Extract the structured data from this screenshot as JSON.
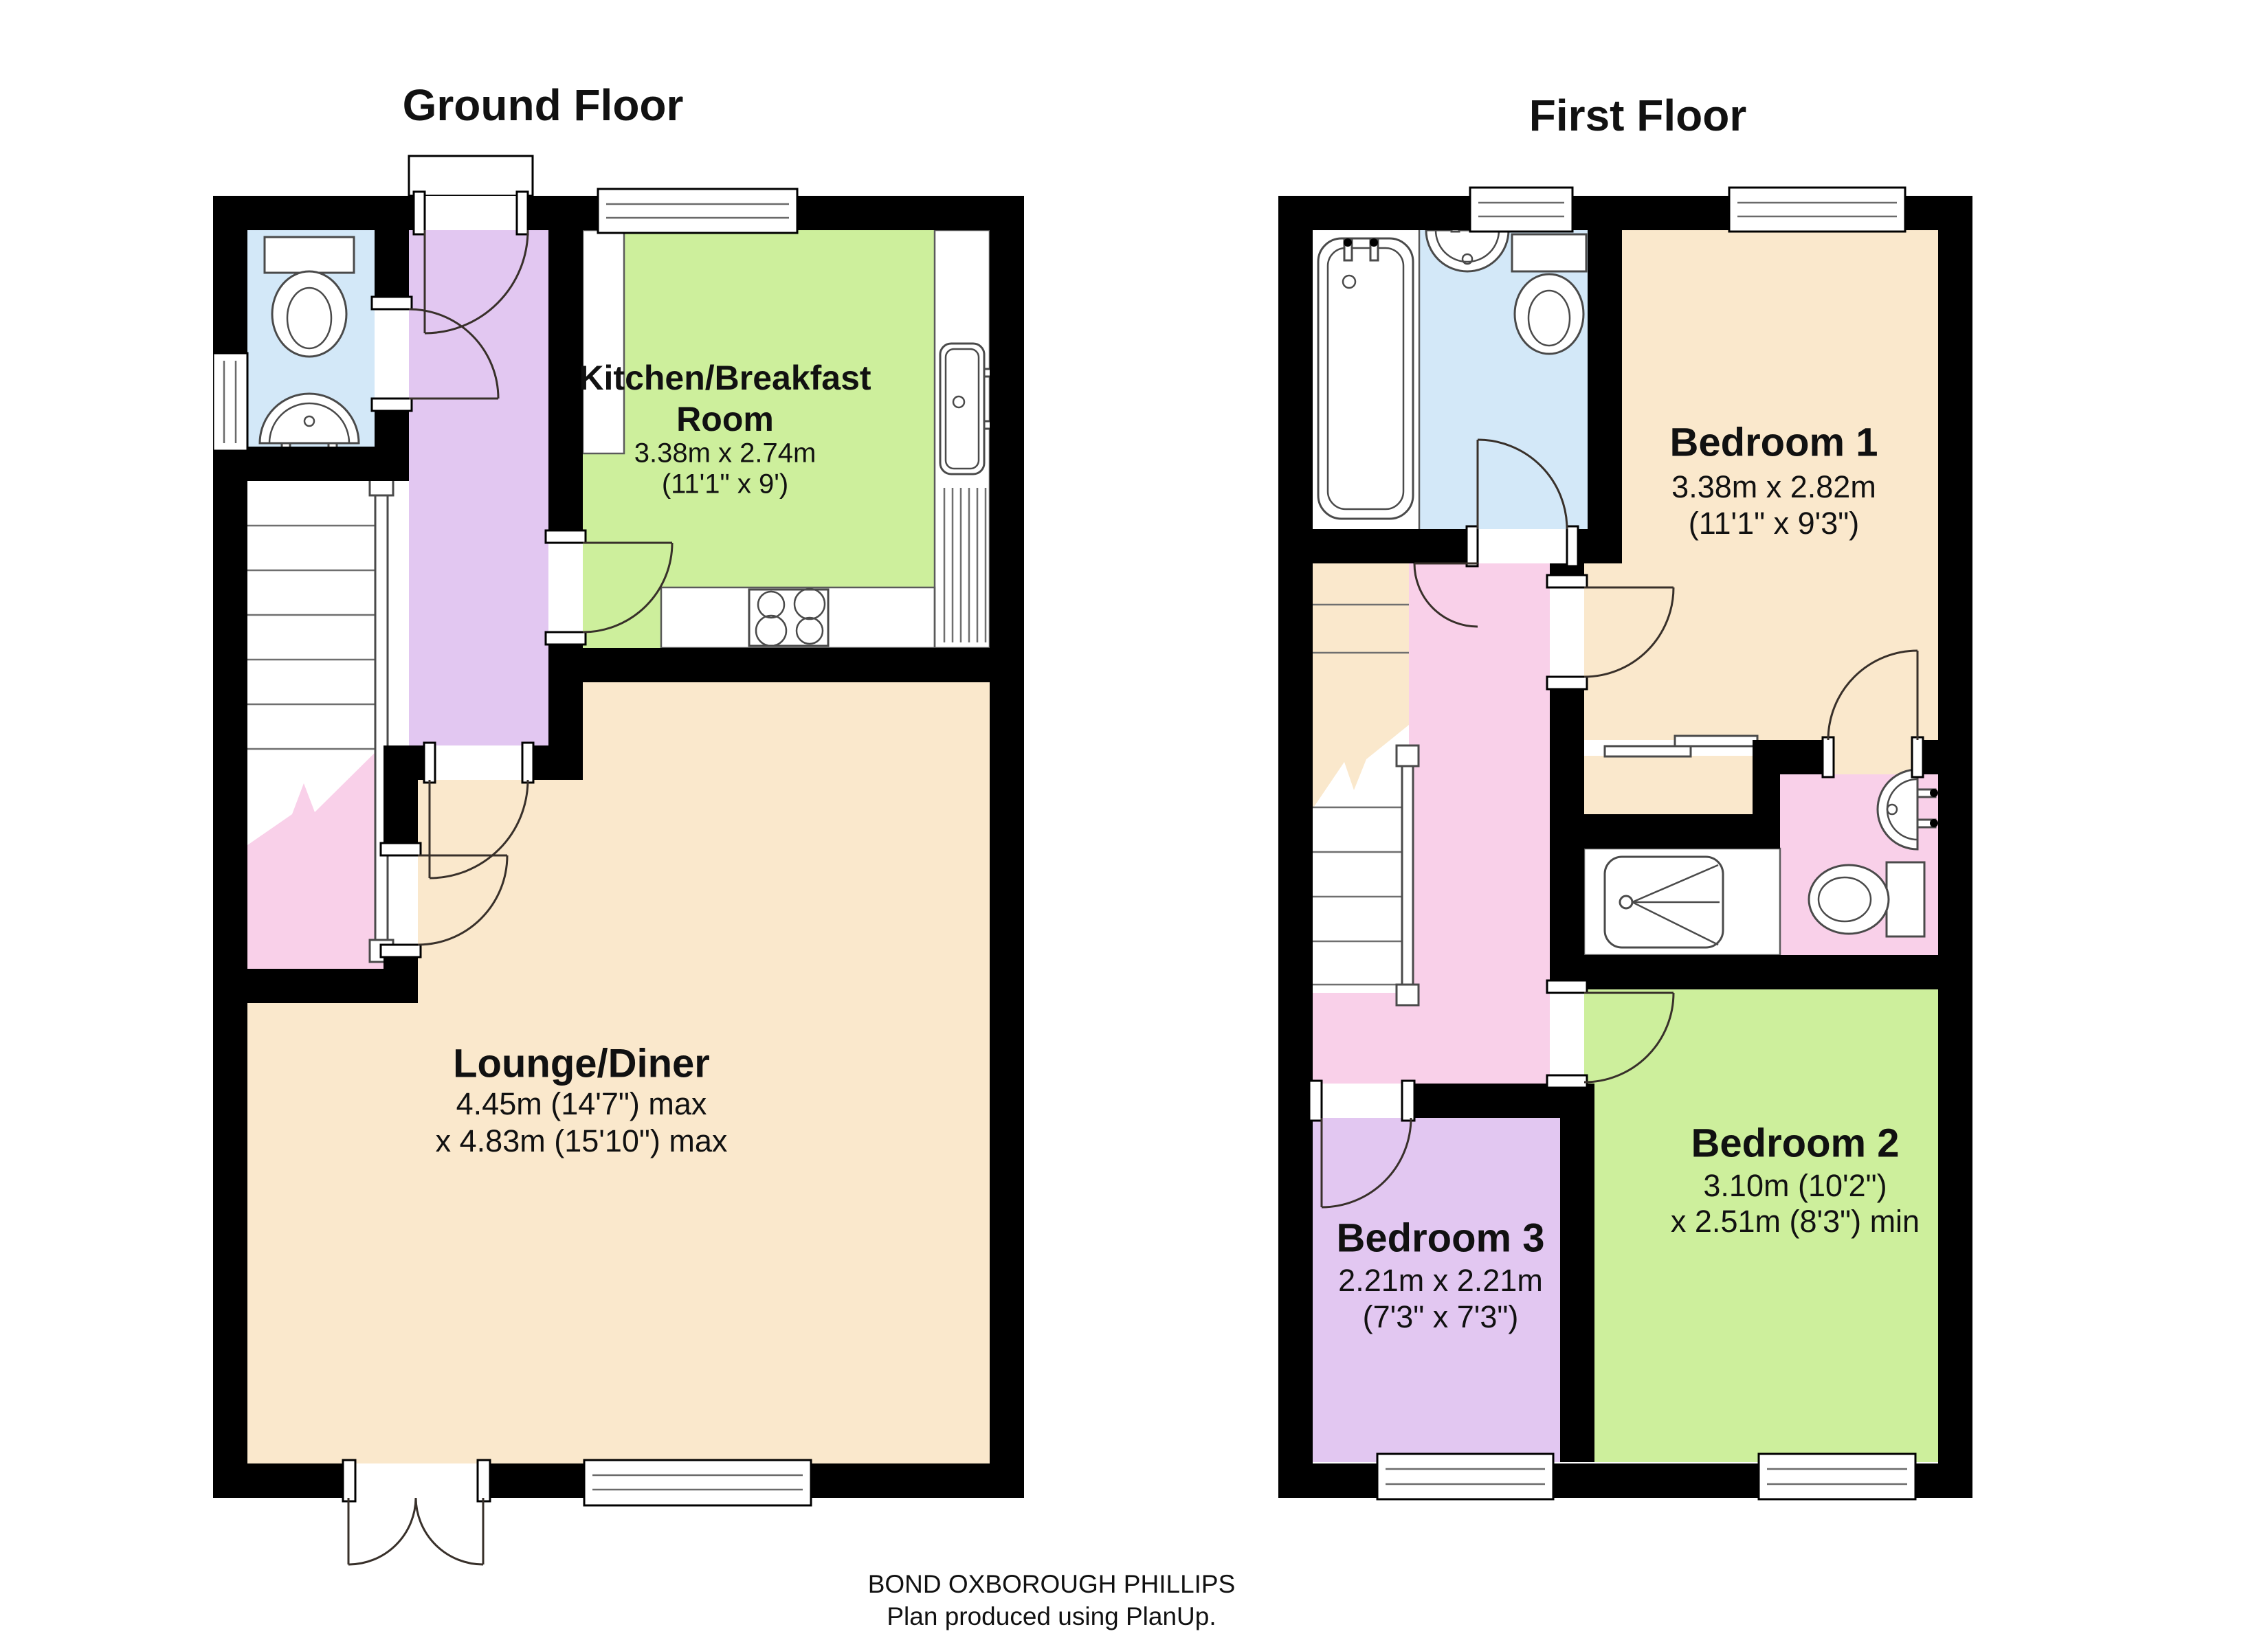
{
  "document": {
    "footer_line1": "BOND OXBOROUGH PHILLIPS",
    "footer_line2": "Plan produced using PlanUp."
  },
  "colors": {
    "wall": "#000000",
    "room_cream": "#FAE8CC",
    "room_green": "#CDEF9C",
    "room_purple": "#E2C7F1",
    "room_blue": "#D3E8F8",
    "room_pink": "#F9D0E9",
    "fixture_white": "#FFFFFF"
  },
  "ground_floor": {
    "title": "Ground Floor",
    "kitchen": {
      "name_line1": "Kitchen/Breakfast",
      "name_line2": "Room",
      "dims_metric": "3.38m x 2.74m",
      "dims_imperial": "(11'1\" x 9')"
    },
    "lounge": {
      "name": "Lounge/Diner",
      "dims_line1": "4.45m (14'7\") max",
      "dims_line2": "x 4.83m (15'10\") max"
    }
  },
  "first_floor": {
    "title": "First Floor",
    "bedroom1": {
      "name": "Bedroom 1",
      "dims_metric": "3.38m x 2.82m",
      "dims_imperial": "(11'1\" x 9'3\")"
    },
    "bedroom2": {
      "name": "Bedroom 2",
      "dims_line1": "3.10m (10'2\")",
      "dims_line2": "x 2.51m (8'3\") min"
    },
    "bedroom3": {
      "name": "Bedroom 3",
      "dims_metric": "2.21m x 2.21m",
      "dims_imperial": "(7'3\" x 7'3\")"
    }
  }
}
